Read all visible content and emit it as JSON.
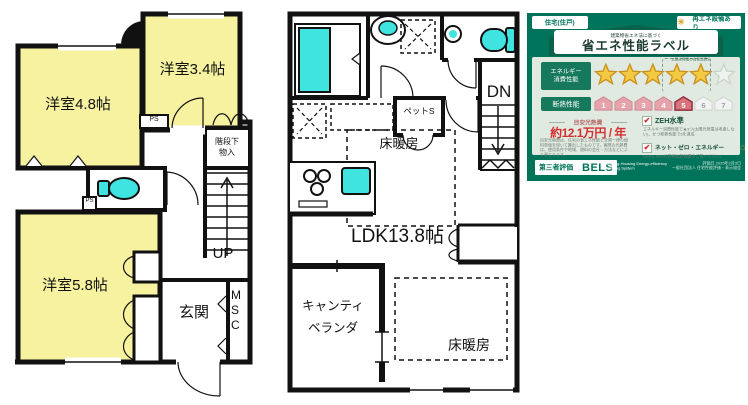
{
  "floor_plan_1f": {
    "room_48": "洋室4.8帖",
    "room_34": "洋室3.4帖",
    "room_58": "洋室5.8帖",
    "ps1": "PS",
    "ps2": "PS",
    "stair_storage_line1": "階段下",
    "stair_storage_line2": "物入",
    "up": "UP",
    "entrance": "玄関",
    "shoe_cabinet": "MSC"
  },
  "floor_plan_2f": {
    "pet_space": "ペットS",
    "floor_heating_upper": "床暖房",
    "ldk": "LDK13.8帖",
    "cantilever_line1": "キャンティ",
    "cantilever_line2": "ベランダ",
    "floor_heating_lower": "床暖房",
    "dn": "DN"
  },
  "energy_label": {
    "housing_type": "住宅(住戸)",
    "renewable_badge": "再エネ設備あり",
    "law_note": "建築物省エネ法に基づく",
    "title": "省エネ性能ラベル",
    "energy_head_line1": "エネルギー",
    "energy_head_line2": "消費性能",
    "solar_self_note": "太陽光発電の自家消費分",
    "stars_filled": 5,
    "stars_total": 6,
    "insulation_head": "断熱性能",
    "insulation_levels": [
      "1",
      "2",
      "3",
      "4",
      "5",
      "6",
      "7"
    ],
    "insulation_achieved": 5,
    "cost_label": "目安光熱費",
    "cost_value": "約12.1万円 / 年",
    "cost_note": "目安光熱費は、住宅の省エネ性能と全国一律の燃料単価を用いて算出したものです。実際の光熱費は、使用条件や地域、燃料の会社・方法などにより異なります。",
    "zeh_label": "ZEH水準",
    "zeh_note": "エネルギー消費性能で★3つ(太陽光発電は考慮しない)、かつ断熱性能で5を達成",
    "nze_label": "ネット・ゼロ・エネルギー",
    "nze_note": "Nearly ZEHの詳細は評価書をご覧ください。",
    "bels_prefix": "第三者評価",
    "bels_name": "BELS",
    "bels_subtitle": "Building-Housing Energy-efficiency Labeling System",
    "eval_date": "評価日 2025年2月3日",
    "issuer": "一般社団法人 住宅性能評価・表示協会",
    "colors": {
      "green": "#00745A",
      "panel": "#E1EAE0",
      "star_gold": "#F3C843",
      "house_pink": "#E7A3AB",
      "house_achieved": "#D9747F",
      "red": "#D42F2F",
      "cyan": "#3FE3E0",
      "room_yellow": "#F6F2A0"
    }
  }
}
